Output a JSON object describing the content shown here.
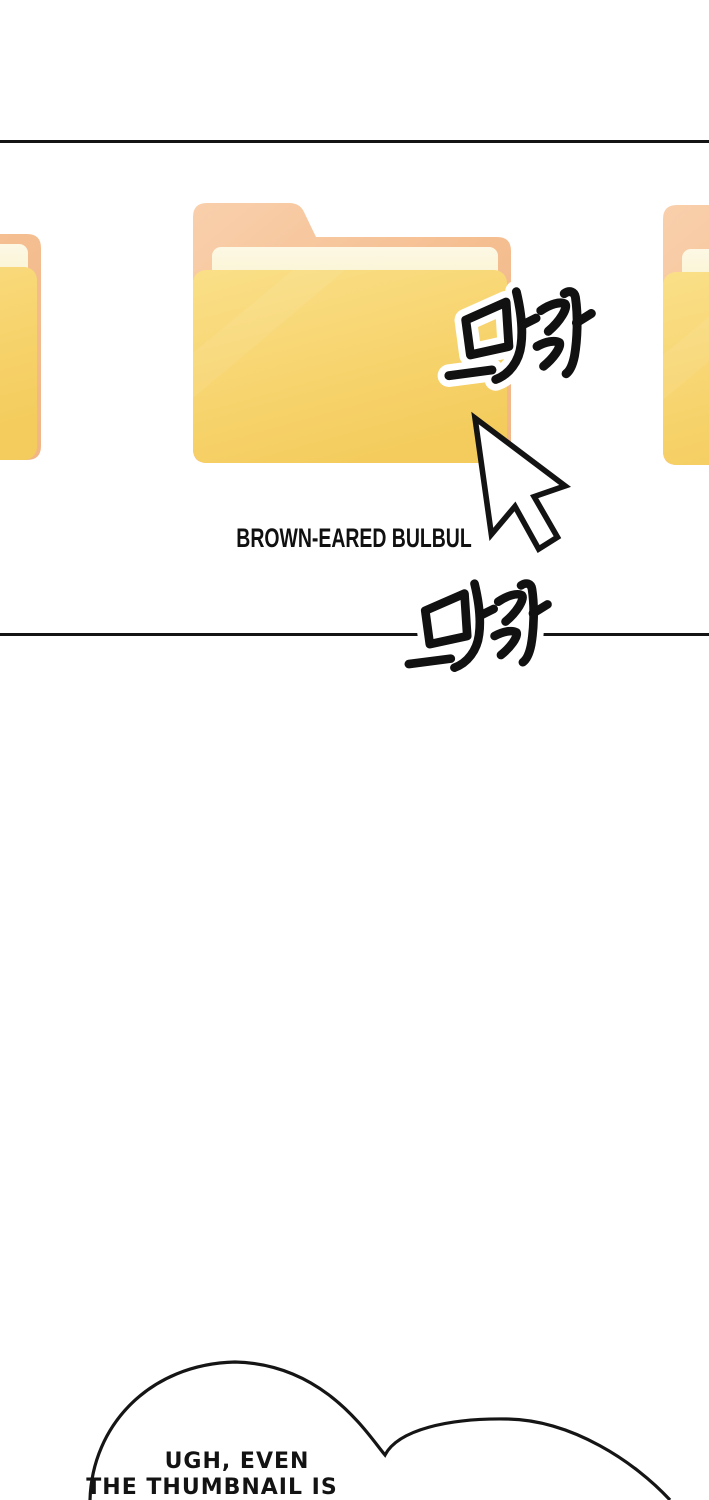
{
  "page": {
    "background": "#ffffff",
    "ink_color": "#131313",
    "type_note": "webtoon panel depicting a file-explorer folder being clicked"
  },
  "folders": {
    "center_label": "BROWN-EARED BULBUL",
    "items": [
      {
        "name": "left folder",
        "partial": true
      },
      {
        "name": "center folder",
        "partial": false,
        "label": "BROWN-EARED BULBUL"
      },
      {
        "name": "right folder",
        "partial": true
      }
    ],
    "colors": {
      "back_tab": "#F9D0AC",
      "back": "#F5BF92",
      "paper": "#FBF4D4",
      "front_light": "#FADF87",
      "front_dark": "#F4CC5D"
    }
  },
  "sfx": {
    "click_1": "달각",
    "click_2": "달각"
  },
  "cursor": {
    "icon": "arrow-pointer",
    "fill": "#ffffff",
    "outline": "#131313"
  },
  "speech_bubble": {
    "line1": "UGH, EVEN",
    "line2": "THE THUMBNAIL IS",
    "fill": "#ffffff",
    "outline": "#131313"
  }
}
